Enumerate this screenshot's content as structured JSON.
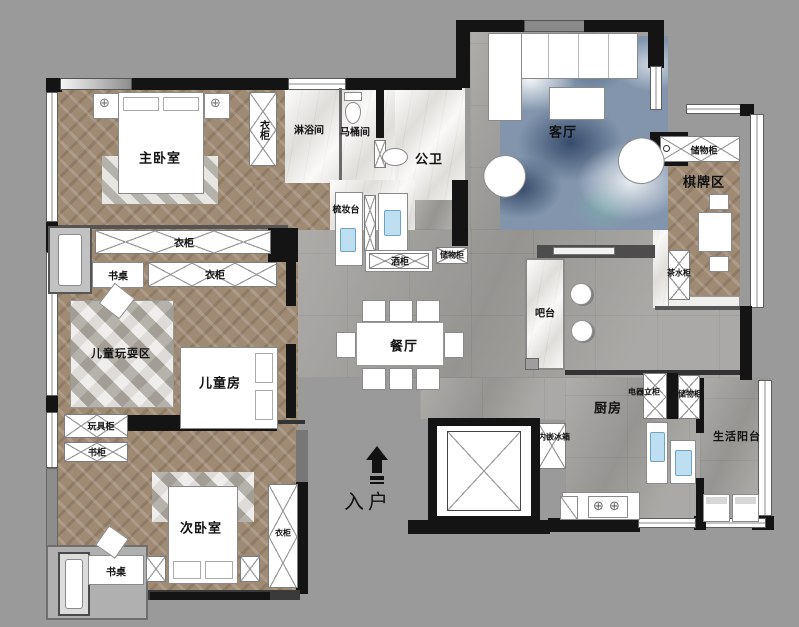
{
  "floor_plan": {
    "rooms": {
      "master_bedroom": "主卧室",
      "shower_room": "淋浴间",
      "toilet_room": "马桶间",
      "public_bathroom": "公卫",
      "living_room": "客厅",
      "chess_card_area": "棋牌区",
      "dining_room": "餐厅",
      "children_play_area": "儿童玩耍区",
      "children_room": "儿童房",
      "second_bedroom": "次卧室",
      "kitchen": "厨房",
      "utility_balcony": "生活阳台",
      "entry": "入户",
      "bar_counter": "吧台"
    },
    "fixtures": {
      "wardrobe": "衣柜",
      "storage_cabinet": "储物柜",
      "desk": "书桌",
      "vanity": "梳妆台",
      "wine_cabinet": "酒柜",
      "tea_cabinet": "茶水柜",
      "toy_cabinet": "玩具柜",
      "bookcase": "书柜",
      "appliance_cabinet": "电器立柜",
      "built_in_fridge": "内嵌冰箱"
    },
    "colors": {
      "background": "#9a9a9a",
      "wall": "#141414",
      "wood_floor": "#9f8b74",
      "tile_floor": "#a2a19e",
      "marble": "#efeeeb",
      "rug_blue": "#8295ad",
      "sink_blue": "#bedff2"
    }
  }
}
